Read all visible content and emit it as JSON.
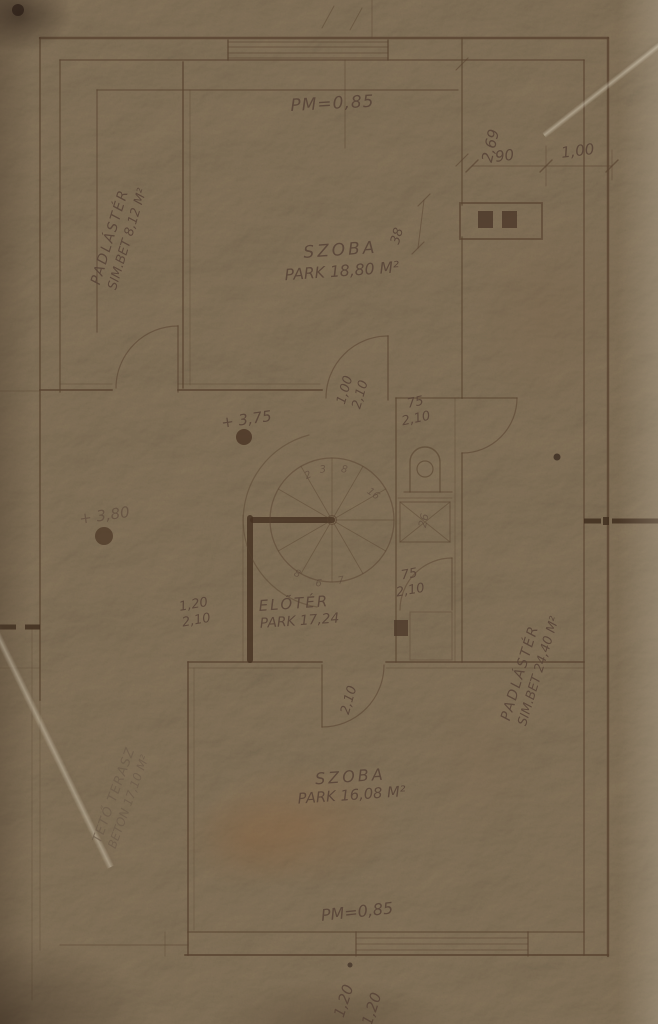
{
  "plan": {
    "levels": {
      "pm_top": "PM=0,85",
      "pm_bottom": "PM=0,85",
      "upper": "+ 3,75",
      "lower": "+ 3,80"
    },
    "dimensions": {
      "d269": "2,69",
      "d90": "90",
      "d100": "1,00",
      "d38": "38",
      "bottom_window": [
        "1,20",
        "1,20"
      ],
      "sink": "26"
    },
    "doors": {
      "main": {
        "w": "1,00",
        "h": "2,10"
      },
      "wc_upper": {
        "w": "75",
        "h": "2,10"
      },
      "wc_lower": {
        "w": "75",
        "h": "2,10"
      },
      "terrace": {
        "w": "1,20",
        "h": "2,10"
      },
      "lower_room": {
        "h": "2,10"
      }
    },
    "rooms": {
      "szoba_upper": {
        "name": "SZOBA",
        "spec": "PARK 18,80 M²"
      },
      "szoba_lower": {
        "name": "SZOBA",
        "spec": "PARK 16,08 M²"
      },
      "eloter": {
        "name": "ELŐTÉR",
        "spec": "PARK 17,24"
      },
      "padlaster_left": {
        "name": "PADLÁSTÉR",
        "spec": "SIM.BET 8,12 M²"
      },
      "padlaster_right": {
        "name": "PADLÁSTÉR",
        "spec": "SIM.BET 24,40 M²"
      },
      "teto_terasz": {
        "name": "TETŐ TERASZ",
        "spec": "BETON 17,10 M²"
      }
    },
    "stair": {
      "numbers": [
        "2",
        "3",
        "8",
        "16",
        "8",
        "6",
        "7"
      ]
    },
    "colors": {
      "paper": "#b3a38e",
      "ink": "#584232",
      "pencil": "#6a5948"
    }
  }
}
